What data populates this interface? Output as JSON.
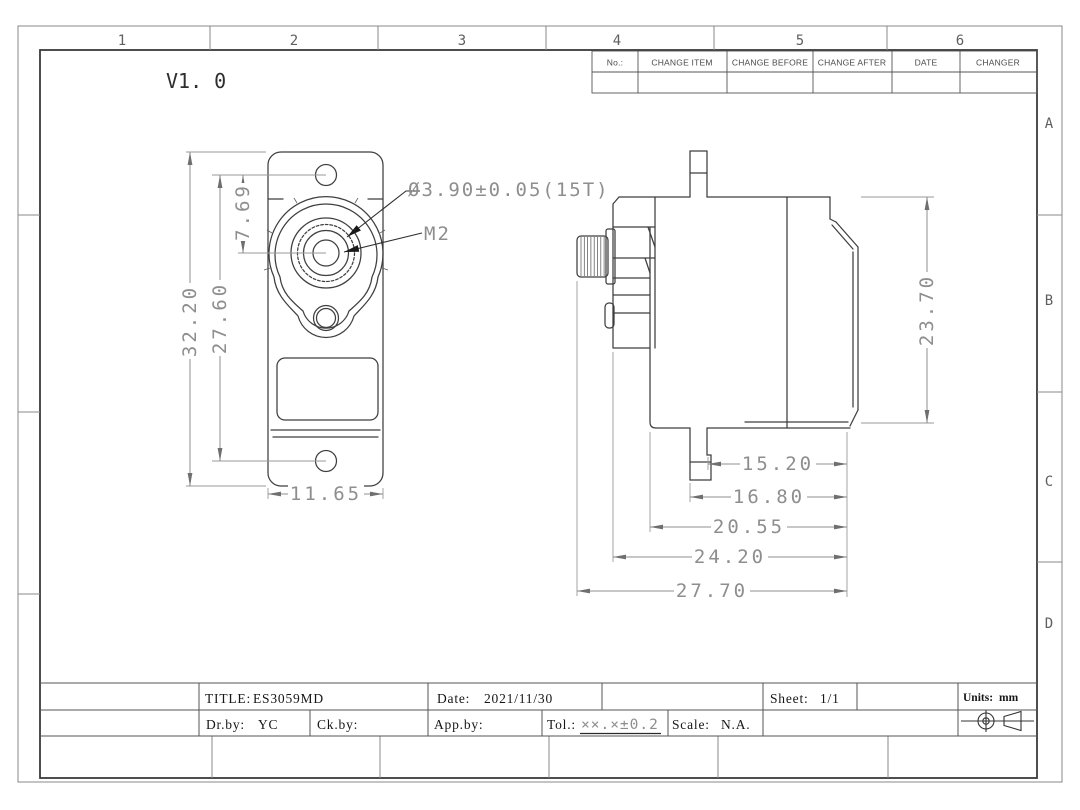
{
  "sheet": {
    "version": "V1. 0"
  },
  "colors": {
    "ink": "#3f3f3f",
    "dimension": "#8e8e8e",
    "frame": "#555555"
  },
  "zones": {
    "cols": [
      "1",
      "2",
      "3",
      "4",
      "5",
      "6"
    ],
    "rows": [
      "A",
      "B",
      "C",
      "D"
    ]
  },
  "revision_table": {
    "headers": [
      "No.:",
      "CHANGE ITEM",
      "CHANGE BEFORE",
      "CHANGE AFTER",
      "DATE",
      "CHANGER"
    ]
  },
  "front_view": {
    "dim_overall_height": "32.20",
    "dim_hole_span": "27.60",
    "dim_shaft_offset": "7.69",
    "dim_width": "11.65",
    "label_spline": "Ø3.90±0.05(15T)",
    "label_screw": "M2"
  },
  "side_view": {
    "dim_height": "23.70",
    "dim_chain": [
      "15.20",
      "16.80",
      "20.55",
      "24.20",
      "27.70"
    ]
  },
  "title_block": {
    "title_label": "TITLE:",
    "title_value": "ES3059MD",
    "date_label": "Date:",
    "date_value": "2021/11/30",
    "sheet_label": "Sheet:",
    "sheet_value": "1/1",
    "units_label": "Units:",
    "units_value": "mm",
    "dr_label": "Dr.by:",
    "dr_value": "YC",
    "ck_label": "Ck.by:",
    "app_label": "App.by:",
    "tol_label": "Tol.:",
    "tol_value": "××.×±0.2",
    "scale_label": "Scale:",
    "scale_value": "N.A."
  }
}
